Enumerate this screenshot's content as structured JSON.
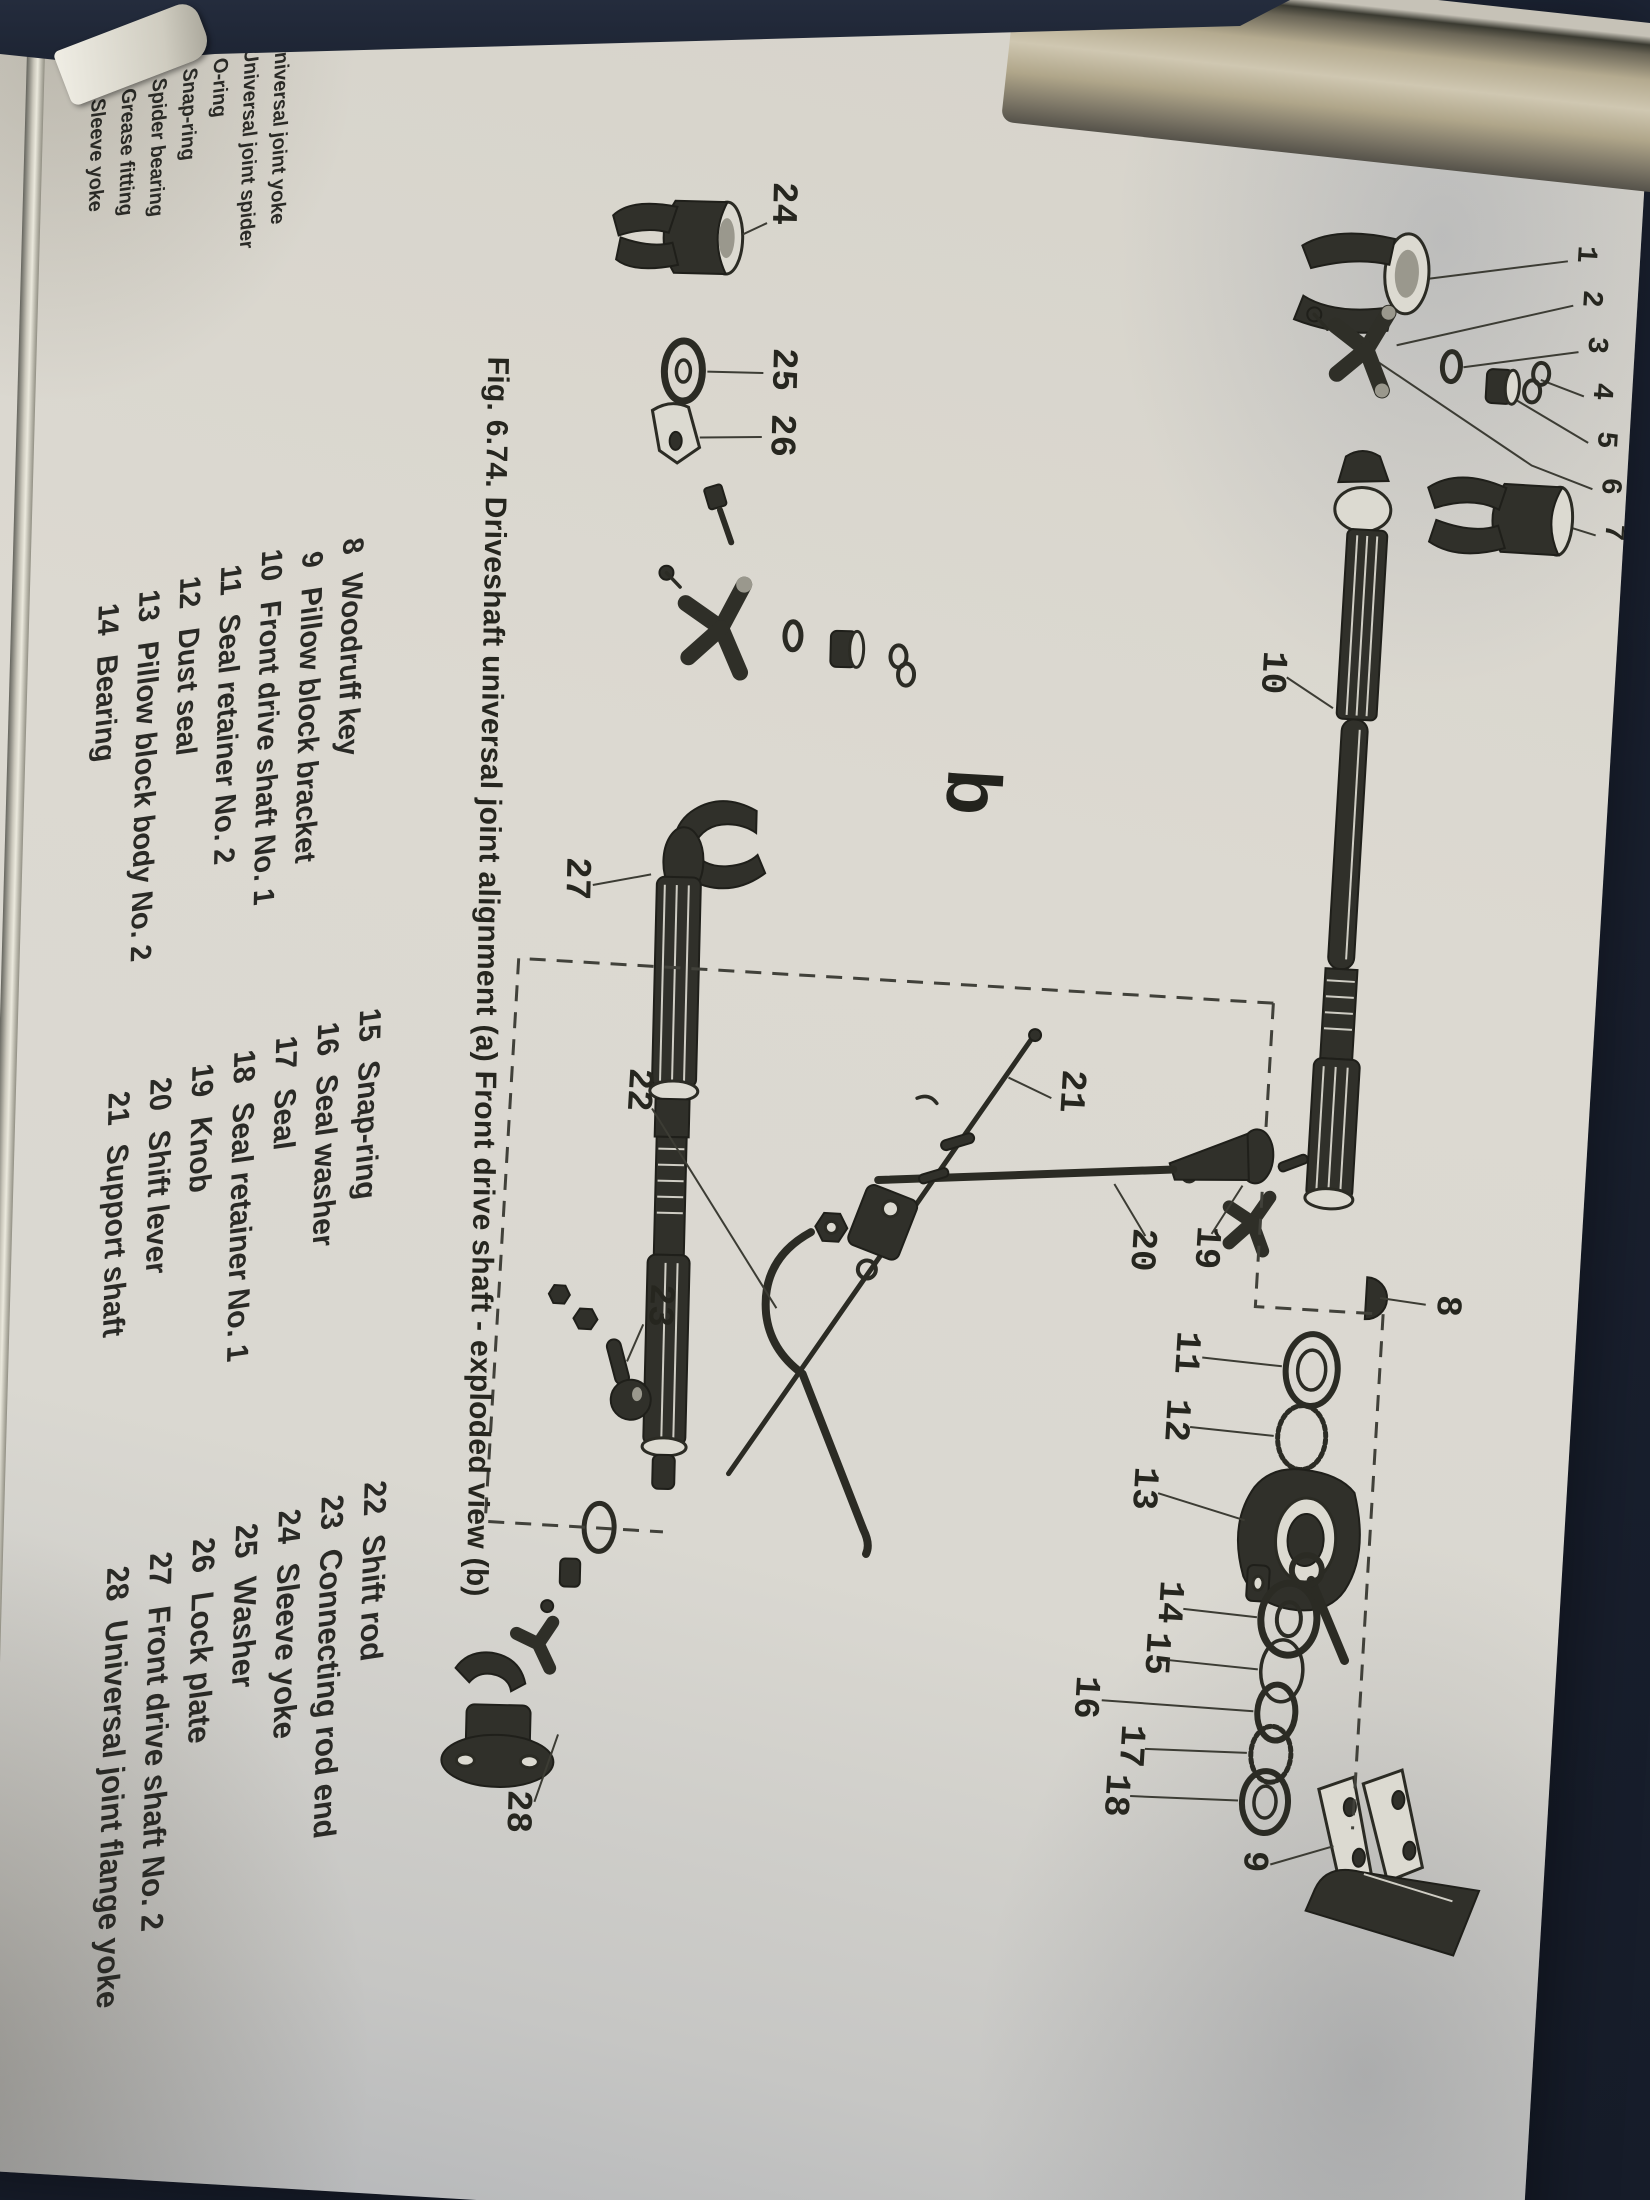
{
  "figure": {
    "caption": "Fig. 6.74. Driveshaft universal joint alignment (a) Front drive shaft - exploded view (b)",
    "sub_label": "b",
    "callouts": {
      "n1": "1",
      "n2": "2",
      "n3": "3",
      "n4": "4",
      "n5": "5",
      "n6": "6",
      "n7": "7",
      "n8": "8",
      "n9": "9",
      "n10": "10",
      "n11": "11",
      "n12": "12",
      "n13": "13",
      "n14": "14",
      "n15": "15",
      "n16": "16",
      "n17": "17",
      "n18": "18",
      "n19": "19",
      "n20": "20",
      "n21": "21",
      "n22": "22",
      "n23": "23",
      "n24": "24",
      "n25": "25",
      "n26": "26",
      "n27": "27",
      "n28": "28"
    }
  },
  "parts_list": {
    "columns": [
      {
        "items": [
          {
            "num": "1",
            "label": "Universal joint yoke"
          },
          {
            "num": "2",
            "label": "Universal joint spider"
          },
          {
            "num": "3",
            "label": "O-ring"
          },
          {
            "num": "4",
            "label": "Snap-ring"
          },
          {
            "num": "5",
            "label": "Spider bearing"
          },
          {
            "num": "6",
            "label": "Grease fitting"
          },
          {
            "num": "7",
            "label": "Sleeve yoke"
          }
        ]
      },
      {
        "items": [
          {
            "num": "8",
            "label": "Woodruff key"
          },
          {
            "num": "9",
            "label": "Pillow block bracket"
          },
          {
            "num": "10",
            "label": "Front drive shaft No. 1"
          },
          {
            "num": "11",
            "label": "Seal retainer No. 2"
          },
          {
            "num": "12",
            "label": "Dust seal"
          },
          {
            "num": "13",
            "label": "Pillow block body No. 2"
          },
          {
            "num": "14",
            "label": "Bearing"
          }
        ]
      },
      {
        "items": [
          {
            "num": "15",
            "label": "Snap-ring"
          },
          {
            "num": "16",
            "label": "Seal washer"
          },
          {
            "num": "17",
            "label": "Seal"
          },
          {
            "num": "18",
            "label": "Seal retainer No. 1"
          },
          {
            "num": "19",
            "label": "Knob"
          },
          {
            "num": "20",
            "label": "Shift lever"
          },
          {
            "num": "21",
            "label": "Support shaft"
          }
        ]
      },
      {
        "items": [
          {
            "num": "22",
            "label": "Shift rod"
          },
          {
            "num": "23",
            "label": "Connecting rod end"
          },
          {
            "num": "24",
            "label": "Sleeve yoke"
          },
          {
            "num": "25",
            "label": "Washer"
          },
          {
            "num": "26",
            "label": "Lock plate"
          },
          {
            "num": "27",
            "label": "Front drive shaft No. 2"
          },
          {
            "num": "28",
            "label": "Universal joint flange yoke"
          }
        ]
      }
    ]
  }
}
